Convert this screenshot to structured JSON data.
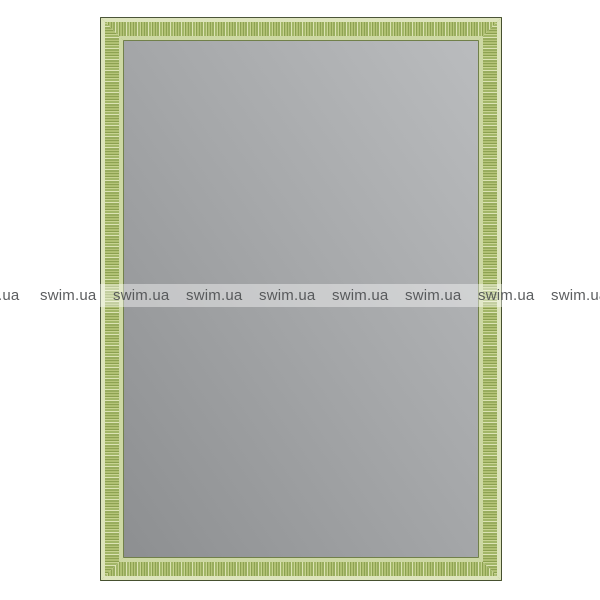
{
  "watermark": {
    "text": "swim.ua",
    "instances": 9,
    "text_color": "#4e5052",
    "band_color": "rgba(255,255,255,0.42)"
  },
  "colors": {
    "background": "#ffffff",
    "frame_outer_line": "#4b5539",
    "frame_outer_band": "#dde4bc",
    "frame_texture_base": "#a2b667",
    "frame_texture_light": "#dce3b4",
    "frame_texture_dark": "#8ba04f",
    "frame_inner_band": "#cdd8a3",
    "frame_inner_line": "#71804a",
    "mirror_gradient_light": "#babcbe",
    "mirror_gradient_dark": "#8d8f91"
  }
}
